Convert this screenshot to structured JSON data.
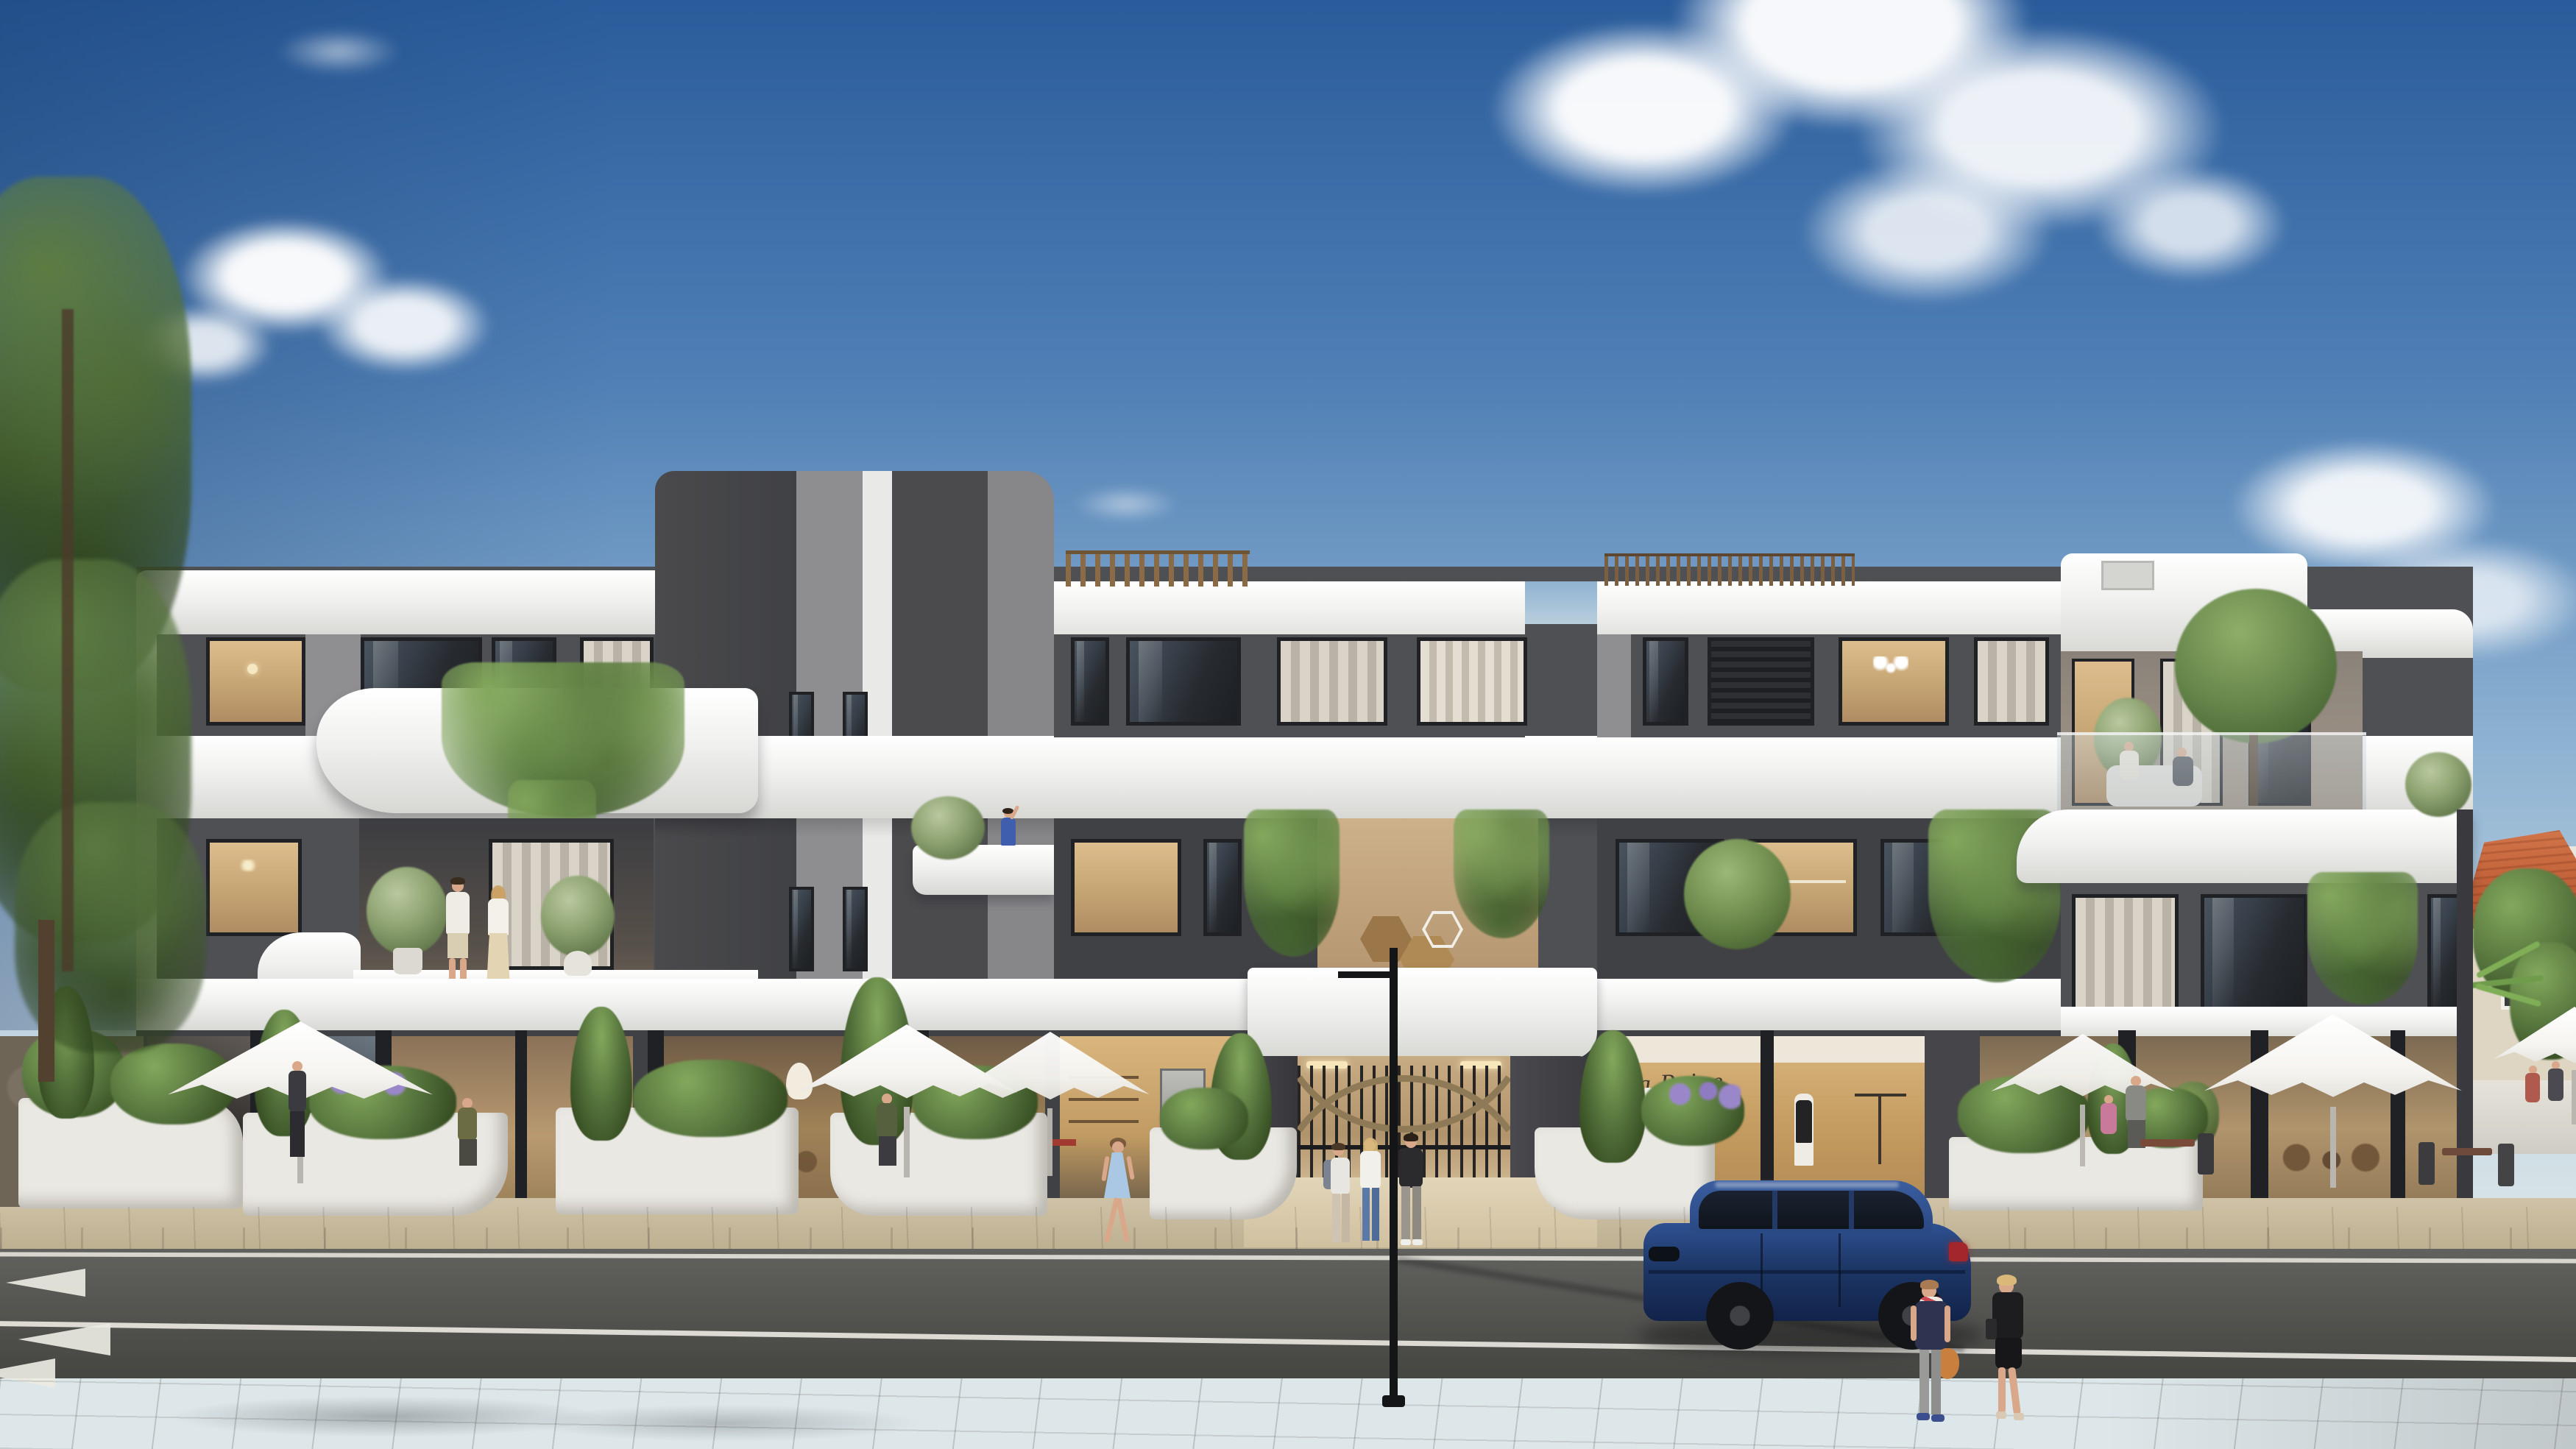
{
  "scene": {
    "type": "photoreal architectural rendering",
    "description": "Street-front view of a modern three/four storey apartment building with white curved concrete bands and charcoal panel facade, ground-floor cafes and boutiques with white parasols, landscaped white planters, an asphalt road with lane markings in the foreground, a parked dark-blue SUV, pedestrians, tall pine trees at the left edge and a terracotta-roofed neighbouring house at the right edge under a blue sky with scattered clouds.",
    "time_of_day": "late afternoon sunlight from the right"
  },
  "signage": {
    "boutique_sign": "La Reine"
  },
  "inventory": {
    "building": "white apartment block with grey striped roof tower and curved balconies",
    "floors_visible": 4,
    "umbrella_count": 6,
    "pedestrian_count": 6,
    "cafe_patron_count": 9,
    "balcony_people": "couple on left balcony, waving woman on centre balcony, two seated on right terrace",
    "vehicle": "dark blue SUV parked at kerb",
    "street_lamp_count": 1,
    "entrance": "central gate with bronze double-arc metalwork and hexagon wood wall art",
    "road_markings": "edge line, centre line, yield shark-tooth triangles lower left",
    "left_edge": "tall dark pine trees and stone wall",
    "right_edge": "neighbour house with terracotta hip roof, palm and green trees"
  },
  "palette": {
    "sky_top": "#2a5c9b",
    "sky_mid": "#4f7fb5",
    "sky_soft": "#8fb3d2",
    "sky_horizon": "#dde7ea",
    "facade_white": "#f0f0ee",
    "facade_shade": "#d7d8d4",
    "panel_charcoal": "#404145",
    "panel_dark": "#4f5054",
    "panel_mid": "#6b6b6f",
    "panel_gray": "#8f8f92",
    "panel_light": "#b9b9ba",
    "frame_dark": "#202125",
    "glass_dark": "#272a2f",
    "glass_warm": "#c9a977",
    "interior_warm": "#b08c62",
    "interior_bright": "#ddbd8d",
    "curtain": "#d9d3c8",
    "wood": "#9b7648",
    "bronze": "#90795a",
    "green_dark": "#33491f",
    "green_mid": "#53713b",
    "green_light": "#83a85c",
    "ivy_green": "#4a6d35",
    "trunk_brown": "#4c3b2a",
    "stone_wall": "#6e6557",
    "road_asphalt": "#565653",
    "road_dark": "#454542",
    "marking_white": "#eceae2",
    "sidewalk_near": "#b6b1a8",
    "sidewalk_far": "#c8b99c",
    "curb_stone": "#958e80",
    "plaza_tile": "#cfc2a6",
    "planter_white": "#eae8e3",
    "umbrella_white": "#f5f4f0",
    "umbrella_shade": "#d9d6d0",
    "car_navy": "#1d3766",
    "car_navy_light": "#2f5192",
    "car_glass": "#10151d",
    "wheel_black": "#141519",
    "taillight_red": "#a3262c",
    "terracotta_roof": "#c06038",
    "house_wall": "#ded6c3",
    "skin": "#d9a88a",
    "lamp_black": "#141517"
  }
}
